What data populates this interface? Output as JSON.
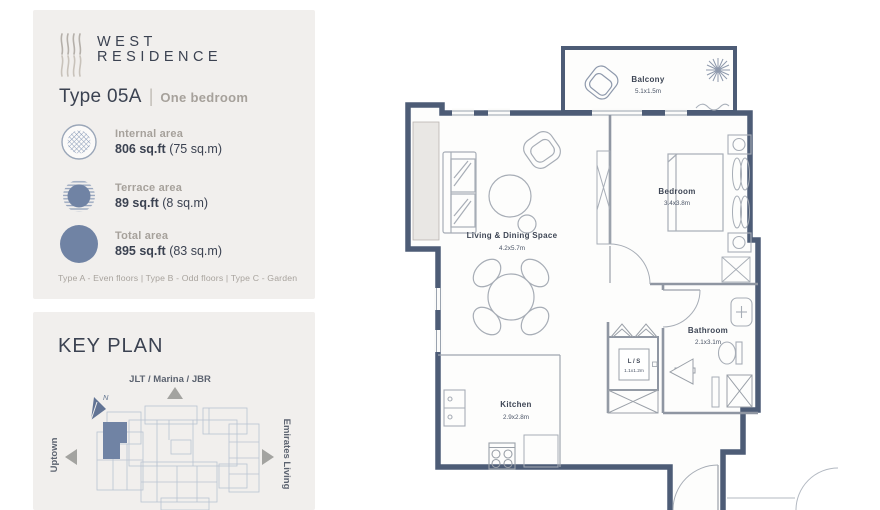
{
  "brand": {
    "name_line1": "WEST",
    "name_line2": "RESIDENCE"
  },
  "unit": {
    "type": "Type 05A",
    "separator": "|",
    "subtitle": "One bedroom"
  },
  "areas": [
    {
      "label": "Internal area",
      "value": "806 sq.ft",
      "metric": " (75 sq.m)"
    },
    {
      "label": "Terrace area",
      "value": "89 sq.ft",
      "metric": " (8 sq.m)"
    },
    {
      "label": "Total area",
      "value": "895 sq.ft",
      "metric": " (83 sq.m)"
    }
  ],
  "floor_note": "Type A - Even floors | Type B - Odd floors | Type C - Garden",
  "key_plan": {
    "title": "KEY PLAN",
    "north_label": "JLT / Marina / JBR",
    "west_label": "Uptown",
    "east_label": "Emirates Living",
    "compass": "N"
  },
  "floor_plan": {
    "rooms": [
      {
        "name": "Balcony",
        "dims": "5.1x1.5m"
      },
      {
        "name": "Living & Dining Space",
        "dims": "4.2x5.7m"
      },
      {
        "name": "Bedroom",
        "dims": "3.4x3.8m"
      },
      {
        "name": "Bathroom",
        "dims": "2.1x3.1m"
      },
      {
        "name": "Kitchen",
        "dims": "2.9x2.8m"
      },
      {
        "name": "L / S",
        "dims": "1.1x1.2m"
      }
    ]
  },
  "colors": {
    "wall": "#4d5c76",
    "interior_line": "#9aa0ab",
    "accent_blue": "#7083a4",
    "panel_bg": "#f1efed",
    "text_dark": "#3b4251",
    "text_muted": "#a6a19b"
  }
}
